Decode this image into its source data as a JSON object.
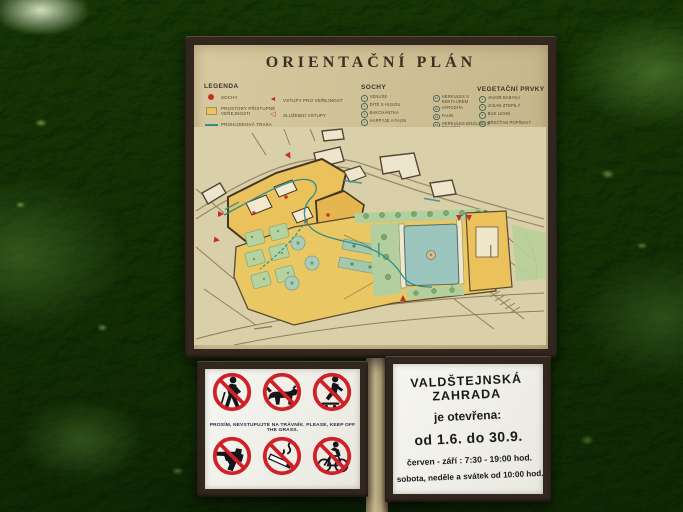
{
  "scene": {
    "description": "Photograph of the orientation board of the Wallenstein Garden mounted on posts in front of a dense green hedge"
  },
  "board": {
    "title": "ORIENTAČNÍ PLÁN",
    "legend": {
      "heading": "LEGENDA",
      "items_left": [
        {
          "symbol": "red-dot",
          "label": "Sochy"
        },
        {
          "symbol": "yellow-square",
          "label": "Prostory přístupné veřejnosti"
        },
        {
          "symbol": "teal-line",
          "label": "Prohlídková trasa"
        },
        {
          "symbol": "teal-dashed-line",
          "label": "Prohlídková trasa pro invalidy"
        }
      ],
      "items_right": [
        {
          "symbol": "red-arrow",
          "label": "Vstupy pro veřejnost"
        },
        {
          "symbol": "red-arrow-outline",
          "label": "Služební vstupy"
        },
        {
          "symbol": "red-arrow-tail",
          "label": "Vstupy do expozic"
        }
      ]
    },
    "statues": {
      "heading": "SOCHY",
      "col1": [
        {
          "n": "1",
          "label": "Venuše"
        },
        {
          "n": "2",
          "label": "Dítě s husou"
        },
        {
          "n": "3",
          "label": "Bakchántka"
        },
        {
          "n": "4",
          "label": "Harpyje a faun"
        },
        {
          "n": "5",
          "label": "Dioskurové (zápasníci)"
        },
        {
          "n": "6",
          "label": "Neptun"
        },
        {
          "n": "7",
          "label": "Laokoon a synové"
        },
        {
          "n": "8",
          "label": "Apollon"
        },
        {
          "n": "9",
          "label": "Adonis"
        },
        {
          "n": "10",
          "label": "Merkur a Psyché"
        }
      ],
      "col2": [
        {
          "n": "11",
          "label": "Herkules s kentaurem"
        },
        {
          "n": "12",
          "label": "Afrodita"
        },
        {
          "n": "13",
          "label": "Faun"
        },
        {
          "n": "14",
          "label": "Herkules bojující s drakem"
        },
        {
          "n": "15",
          "label": "Bakchus"
        },
        {
          "n": "16",
          "label": "Zápasící koně"
        }
      ]
    },
    "vegetation": {
      "heading": "VEGETAČNÍ PRVKY",
      "items": [
        {
          "n": "1",
          "label": "Javor babyka"
        },
        {
          "n": "2",
          "label": "Jasan ztepilý"
        },
        {
          "n": "3",
          "label": "Buk lesní"
        },
        {
          "n": "4",
          "label": "Břečťan popínavý"
        },
        {
          "n": "5",
          "label": "Lípa srdčitá"
        },
        {
          "n": "6",
          "label": "Habr obecný"
        },
        {
          "n": "7",
          "label": "Platan javorolistý"
        },
        {
          "n": "8",
          "label": "Růžové záhony"
        },
        {
          "n": "9",
          "label": "Jinan dvoulaločný"
        },
        {
          "n": "10",
          "label": "Magnolie"
        },
        {
          "n": "11",
          "label": "Zimostráz"
        }
      ],
      "notes": [
        "Kvetoucí keře",
        "Květinové záhony letniček"
      ]
    }
  },
  "rules_sign": {
    "caption": "PROSÍM, NEVSTUPUJTE NA TRÁVNÍK.  PLEASE, KEEP OFF THE GRASS.",
    "pictograms": [
      "no-walking-on-grass",
      "no-dogs",
      "no-skating",
      "no-firearms",
      "no-smoking",
      "no-cycling"
    ]
  },
  "hours_sign": {
    "title": "VALDŠTEJNSKÁ ZAHRADA",
    "line_open": "je otevřena:",
    "line_dates": "od 1.6. do 30.9.",
    "line_hours": "červen - září :  7:30 - 19:00 hod.",
    "line_weekend": "sobota, neděle a svátek od 10:00 hod."
  },
  "colors": {
    "frame_brown": "#32271e",
    "board_tan": "#cfc199",
    "map_paper": "#d9cfa8",
    "accent_red": "#c23026",
    "route_teal": "#2f8f8a",
    "palace_yellow": "#ecc25e",
    "bed_green": "#aecf9c",
    "pond_blue": "#9cc6bf",
    "sign_white": "#f3f2ec"
  }
}
